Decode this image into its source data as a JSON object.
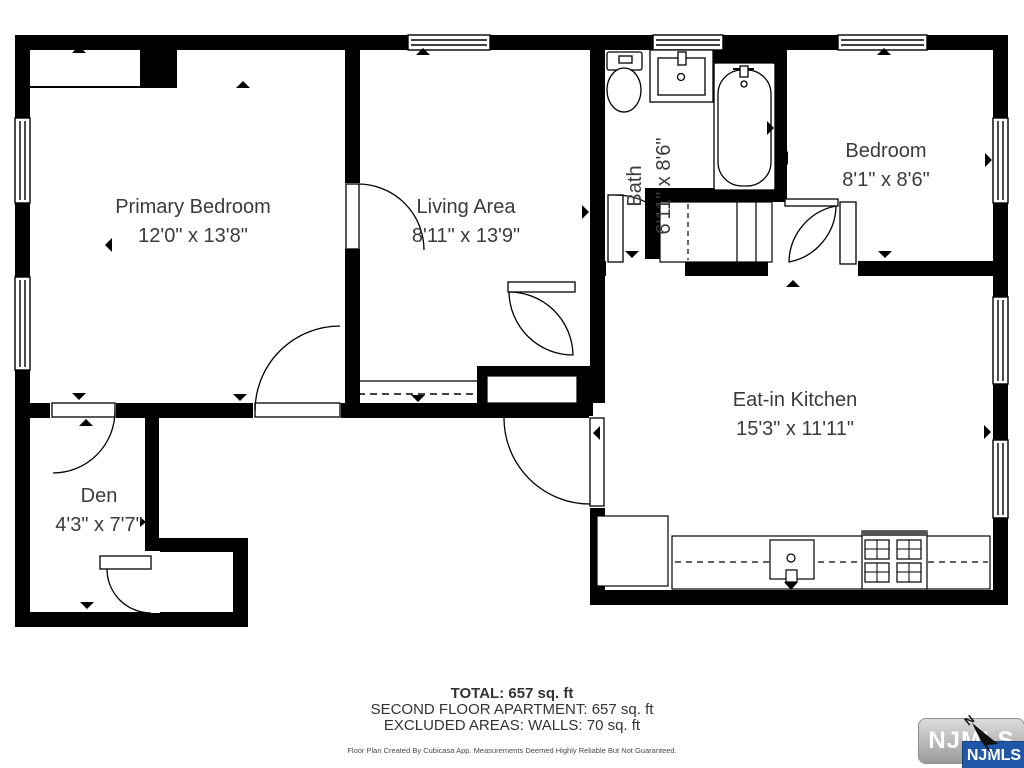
{
  "plan": {
    "rooms": [
      {
        "id": "primary-bedroom",
        "name": "Primary Bedroom",
        "dims": "12'0\" x 13'8\""
      },
      {
        "id": "living-area",
        "name": "Living Area",
        "dims": "8'11\" x 13'9\""
      },
      {
        "id": "bath",
        "name": "Bath",
        "dims": "6'11\" x 8'6\""
      },
      {
        "id": "bedroom",
        "name": "Bedroom",
        "dims": "8'1\" x 8'6\""
      },
      {
        "id": "eat-in-kitchen",
        "name": "Eat-in Kitchen",
        "dims": "15'3\" x 11'11\""
      },
      {
        "id": "den",
        "name": "Den",
        "dims": "4'3\" x 7'7\""
      }
    ],
    "fixtures": [
      "toilet",
      "bathroom-sink",
      "bathtub",
      "stairs",
      "refrigerator",
      "kitchen-counter",
      "kitchen-sink",
      "stove"
    ]
  },
  "summary": {
    "total": "TOTAL: 657 sq. ft",
    "floor": "SECOND FLOOR APARTMENT: 657 sq. ft",
    "excluded": "EXCLUDED AREAS: WALLS: 70 sq. ft",
    "disclaimer": "Floor Plan Created By Cubicasa App. Measurements Deemed Highly Reliable But Not Guaranteed."
  },
  "watermark": {
    "logo_text": "NJMLS",
    "badge_text": "NJMLS",
    "compass_label": "N"
  },
  "colors": {
    "wall": "#000000",
    "label_text": "#3b3b3b",
    "footer_text": "#333333",
    "badge_blue": "#2157a7",
    "watermark_gray": "#a9a9a9"
  }
}
